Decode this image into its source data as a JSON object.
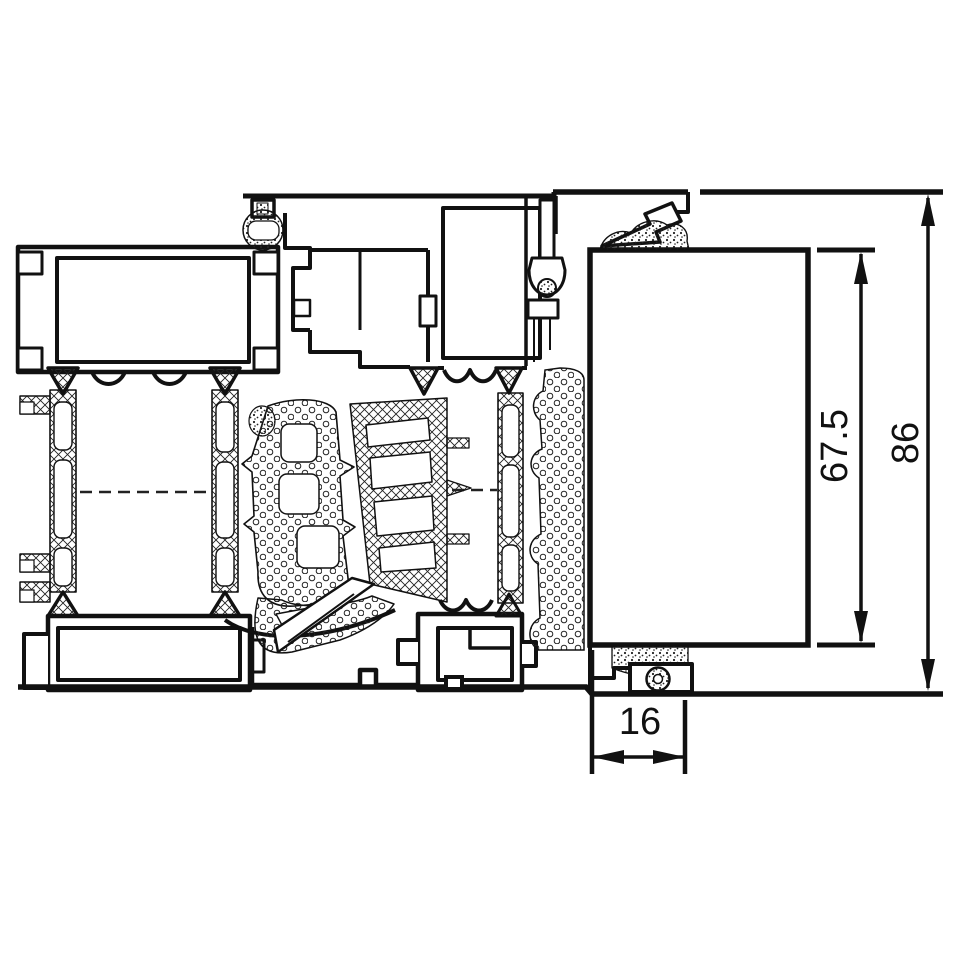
{
  "drawing": {
    "kind": "aluminium-window-profile-cross-section",
    "background_color": "#ffffff",
    "line_color": "#111111",
    "dimensions": {
      "glazing_height": "67.5",
      "overall_height": "86",
      "bottom_width": "16"
    }
  }
}
